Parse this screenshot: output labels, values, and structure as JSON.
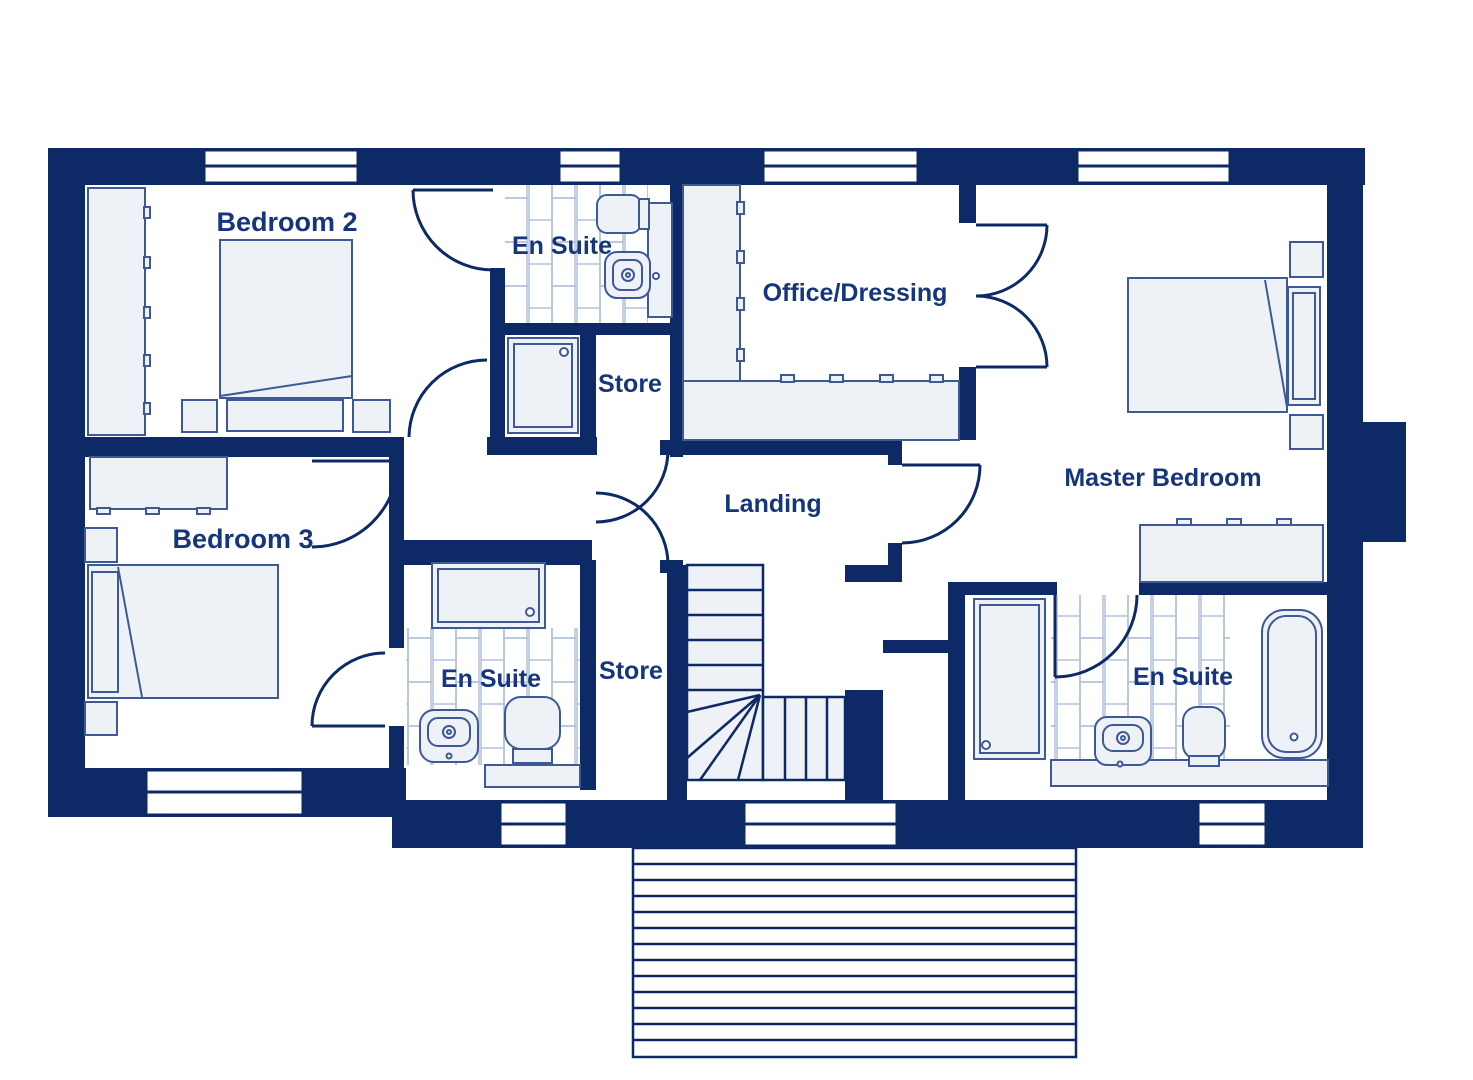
{
  "title": "House first floor plan",
  "colors": {
    "wall_navy": "#0d2a66",
    "label_blue": "#16357d",
    "furniture_fill": "#eef1f5",
    "furniture_stroke": "#3d5a96",
    "tile_stroke": "#b3c0da",
    "floor_white": "#ffffff"
  },
  "rooms": [
    {
      "id": "bedroom2",
      "label": "Bedroom 2"
    },
    {
      "id": "ensuite_top",
      "label": "En Suite"
    },
    {
      "id": "office_dressing",
      "label": "Office/Dressing"
    },
    {
      "id": "store_top",
      "label": "Store"
    },
    {
      "id": "landing",
      "label": "Landing"
    },
    {
      "id": "master_bedroom",
      "label": "Master Bedroom"
    },
    {
      "id": "bedroom3",
      "label": "Bedroom 3"
    },
    {
      "id": "ensuite_bottom_left",
      "label": "En Suite"
    },
    {
      "id": "store_bottom",
      "label": "Store"
    },
    {
      "id": "ensuite_bottom_right",
      "label": "En Suite"
    }
  ],
  "fixtures": [
    "double-bed",
    "wardrobe",
    "bedside-table",
    "dresser",
    "toilet",
    "wash-basin",
    "shower-tray",
    "bathtub",
    "vanity-counter",
    "staircase-with-winders",
    "decking"
  ],
  "window_count": 8,
  "door_count": 9,
  "floor_features": {
    "tiled_rooms": 3,
    "deck_planks": 13,
    "stair_straight_treads_upper": 4,
    "stair_straight_treads_lower": 3,
    "stair_winders": 4
  }
}
